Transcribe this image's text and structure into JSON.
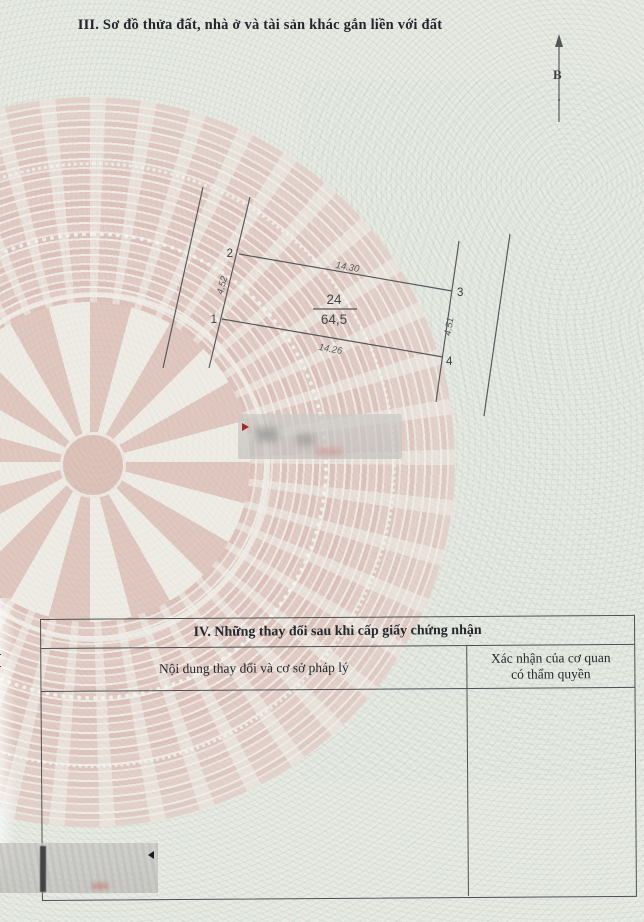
{
  "document": {
    "section3_title": "III. Sơ đồ thửa đất, nhà ở và tài sản khác gắn liền với đất",
    "north_arrow_label": "B",
    "edge_fragment": "I"
  },
  "plot_diagram": {
    "parcel_number": "24",
    "parcel_area": "64,5",
    "vertex_labels": {
      "v1": "1",
      "v2": "2",
      "v3": "3",
      "v4": "4"
    },
    "edge_lengths": {
      "top": "14.30",
      "left": "4,52",
      "right": "4.51",
      "bottom": "14.26"
    }
  },
  "section4_table": {
    "title": "IV. Những thay đổi sau khi cấp giấy chứng nhận",
    "col1_header": "Nội dung thay đổi và cơ sở pháp lý",
    "col2_header_line1": "Xác nhận của cơ quan",
    "col2_header_line2": "có thẩm quyền"
  },
  "colors": {
    "drum_pink": "#dcb2aa",
    "paper_green": "#e9ece5",
    "ink": "#26272d",
    "red_marker": "#a8282a"
  }
}
